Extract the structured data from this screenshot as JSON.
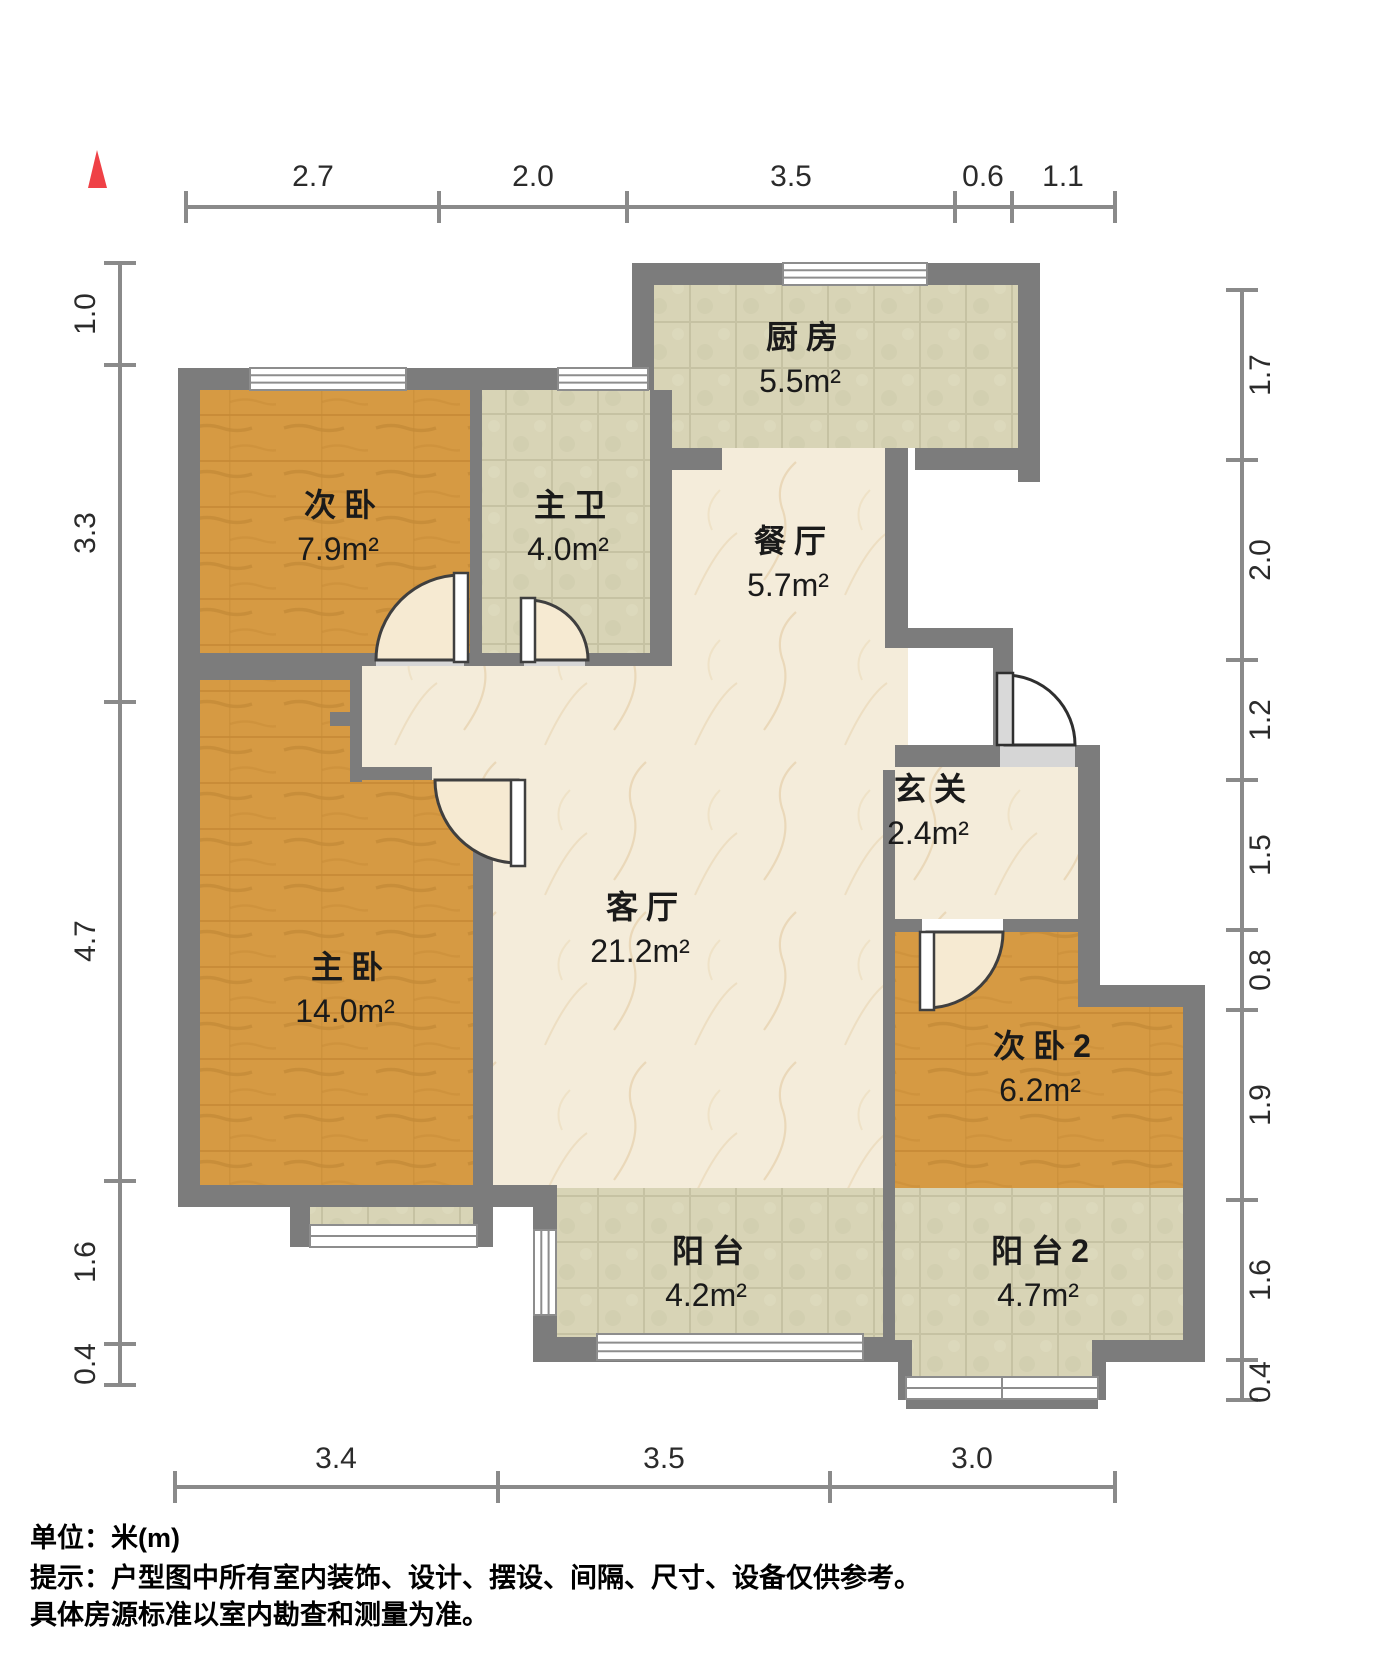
{
  "title": "户型图 (floor plan)",
  "north_marker": "north-arrow",
  "colors": {
    "wall": "#7c7c7c",
    "wood_floor": "#d69a43",
    "tile_floor": "#d8d4b6",
    "marble_floor": "#f4ecda",
    "north_arrow": "#ef4146",
    "dim_line": "#8a8a8a",
    "label_text": "#1a1a1a"
  },
  "rooms": [
    {
      "name": "次卧",
      "area": "7.9m²",
      "floor": "wood"
    },
    {
      "name": "主卫",
      "area": "4.0m²",
      "floor": "tile"
    },
    {
      "name": "厨房",
      "area": "5.5m²",
      "floor": "tile"
    },
    {
      "name": "餐厅",
      "area": "5.7m²",
      "floor": "marble"
    },
    {
      "name": "玄关",
      "area": "2.4m²",
      "floor": "marble"
    },
    {
      "name": "客厅",
      "area": "21.2m²",
      "floor": "marble"
    },
    {
      "name": "主卧",
      "area": "14.0m²",
      "floor": "wood"
    },
    {
      "name": "次卧2",
      "area": "6.2m²",
      "floor": "wood"
    },
    {
      "name": "阳台",
      "area": "4.2m²",
      "floor": "tile"
    },
    {
      "name": "阳台2",
      "area": "4.7m²",
      "floor": "tile"
    }
  ],
  "dimensions": {
    "unit": "m",
    "top": [
      "2.7",
      "2.0",
      "3.5",
      "0.6",
      "1.1"
    ],
    "left": [
      "1.0",
      "3.3",
      "4.7",
      "1.6",
      "0.4"
    ],
    "right": [
      "1.7",
      "2.0",
      "1.2",
      "1.5",
      "0.8",
      "1.9",
      "1.6",
      "0.4"
    ],
    "bottom": [
      "3.4",
      "3.5",
      "3.0"
    ]
  },
  "footer": {
    "unit_line": "单位：米(m)",
    "tip_line1": "提示：户型图中所有室内装饰、设计、摆设、间隔、尺寸、设备仅供参考。",
    "tip_line2": "具体房源标准以室内勘查和测量为准。"
  }
}
